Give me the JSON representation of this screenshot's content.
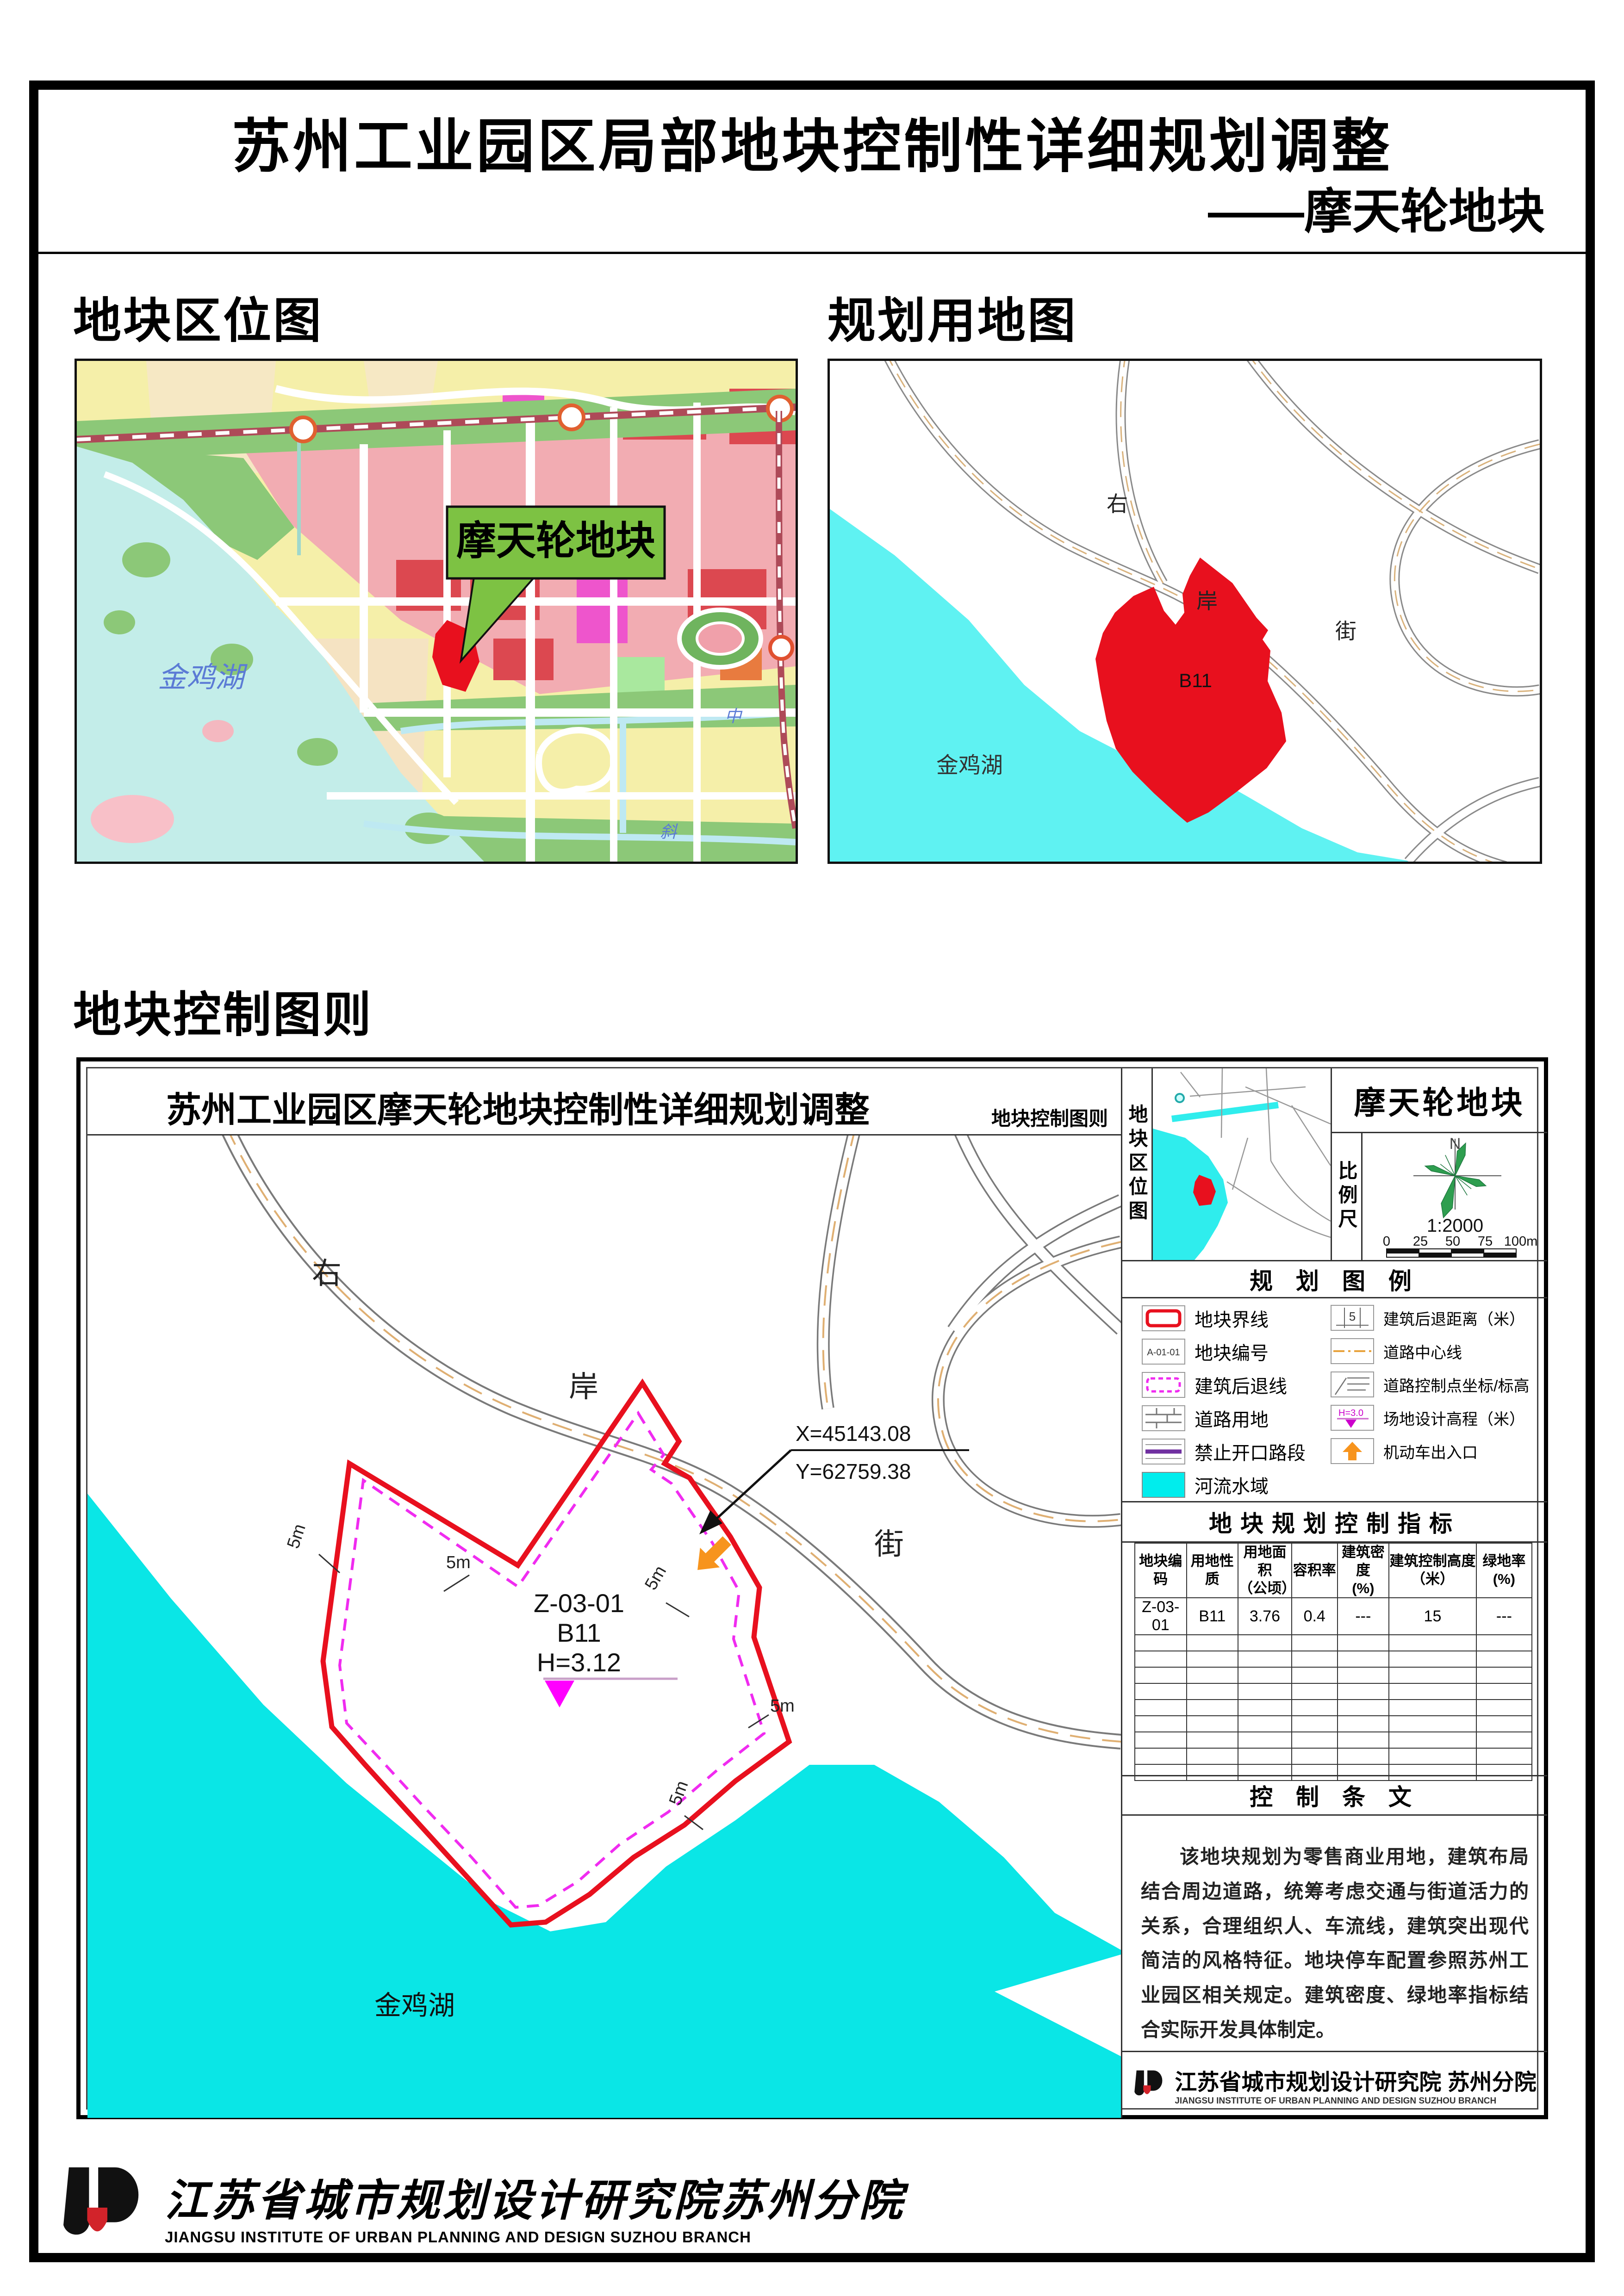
{
  "page": {
    "title_line1": "苏州工业园区局部地块控制性详细规划调整",
    "title_line2": "——摩天轮地块"
  },
  "sections": {
    "location_map_label": "地块区位图",
    "landuse_map_label": "规划用地图",
    "control_chart_label": "地块控制图则"
  },
  "location_map": {
    "callout": "摩天轮地块",
    "lake_label": "金鸡湖",
    "river_label_mid": "中",
    "river_label_xie": "斜"
  },
  "landuse_map": {
    "parcel_code": "B11",
    "lake_label": "金鸡湖",
    "road_char_1": "右",
    "road_char_2": "岸",
    "road_char_3": "街"
  },
  "control_chart": {
    "frame_title": "苏州工业园区摩天轮地块控制性详细规划调整",
    "frame_subtitle": "地块控制图则",
    "drawing": {
      "road_char_1": "右",
      "road_char_2": "岸",
      "road_char_3": "街",
      "lake_label": "金鸡湖",
      "parcel_line1": "Z-03-01",
      "parcel_line2": "B11",
      "parcel_line3": "H=3.12",
      "coord_x": "X=45143.08",
      "coord_y": "Y=62759.38",
      "dim_label": "5m"
    },
    "side_panel": {
      "location_thumb_label": "地块区位图",
      "scale_label": "比例尺",
      "panel_title": "摩天轮地块",
      "north_label": "N",
      "scale_ratio": "1:2000",
      "scale_ticks": [
        "0",
        "25",
        "50",
        "75",
        "100m"
      ],
      "legend": {
        "title": "规 划 图 例",
        "left": [
          {
            "label": "地块界线"
          },
          {
            "label": "地块编号",
            "icon_text": "A-01-01"
          },
          {
            "label": "建筑后退线"
          },
          {
            "label": "道路用地"
          },
          {
            "label": "禁止开口路段"
          },
          {
            "label": "河流水域"
          }
        ],
        "right": [
          {
            "label": "建筑后退距离（米）",
            "icon_text": "5"
          },
          {
            "label": "道路中心线"
          },
          {
            "label": "道路控制点坐标/标高"
          },
          {
            "label": "场地设计高程（米）",
            "icon_text": "H=3.0"
          },
          {
            "label": "机动车出入口"
          }
        ]
      },
      "indicators": {
        "title": "地块规划控制指标",
        "headers": [
          {
            "l1": "地块编码",
            "l2": ""
          },
          {
            "l1": "用地性质",
            "l2": ""
          },
          {
            "l1": "用地面积",
            "l2": "（公顷）"
          },
          {
            "l1": "容积率",
            "l2": ""
          },
          {
            "l1": "建筑密度",
            "l2": "(%)"
          },
          {
            "l1": "建筑控制高度",
            "l2": "（米）"
          },
          {
            "l1": "绿地率",
            "l2": "(%)"
          }
        ],
        "row": [
          "Z-03-01",
          "B11",
          "3.76",
          "0.4",
          "---",
          "15",
          "---"
        ]
      },
      "provisions": {
        "title": "控 制 条 文",
        "text": "该地块规划为零售商业用地，建筑布局结合周边道路，统筹考虑交通与街道活力的关系，合理组织人、车流线，建筑突出现代简洁的风格特征。地块停车配置参照苏州工业园区相关规定。建筑密度、绿地率指标结合实际开发具体制定。"
      },
      "institute": {
        "name_cn": "江苏省城市规划设计研究院 苏州分院",
        "name_en": "JIANGSU INSTITUTE OF URBAN PLANNING AND DESIGN SUZHOU BRANCH"
      }
    }
  },
  "footer": {
    "name_cn": "江苏省城市规划设计研究院苏州分院",
    "name_en": "JIANGSU INSTITUTE OF URBAN PLANNING AND DESIGN SUZHOU BRANCH"
  },
  "colors": {
    "plot_red": "#E8101E",
    "water_cyan": "#0AE6E6",
    "setback_magenta": "#F02BF0",
    "entry_orange": "#F7941D",
    "callout_green": "#7DC243",
    "no_access_purple": "#7030A0"
  }
}
